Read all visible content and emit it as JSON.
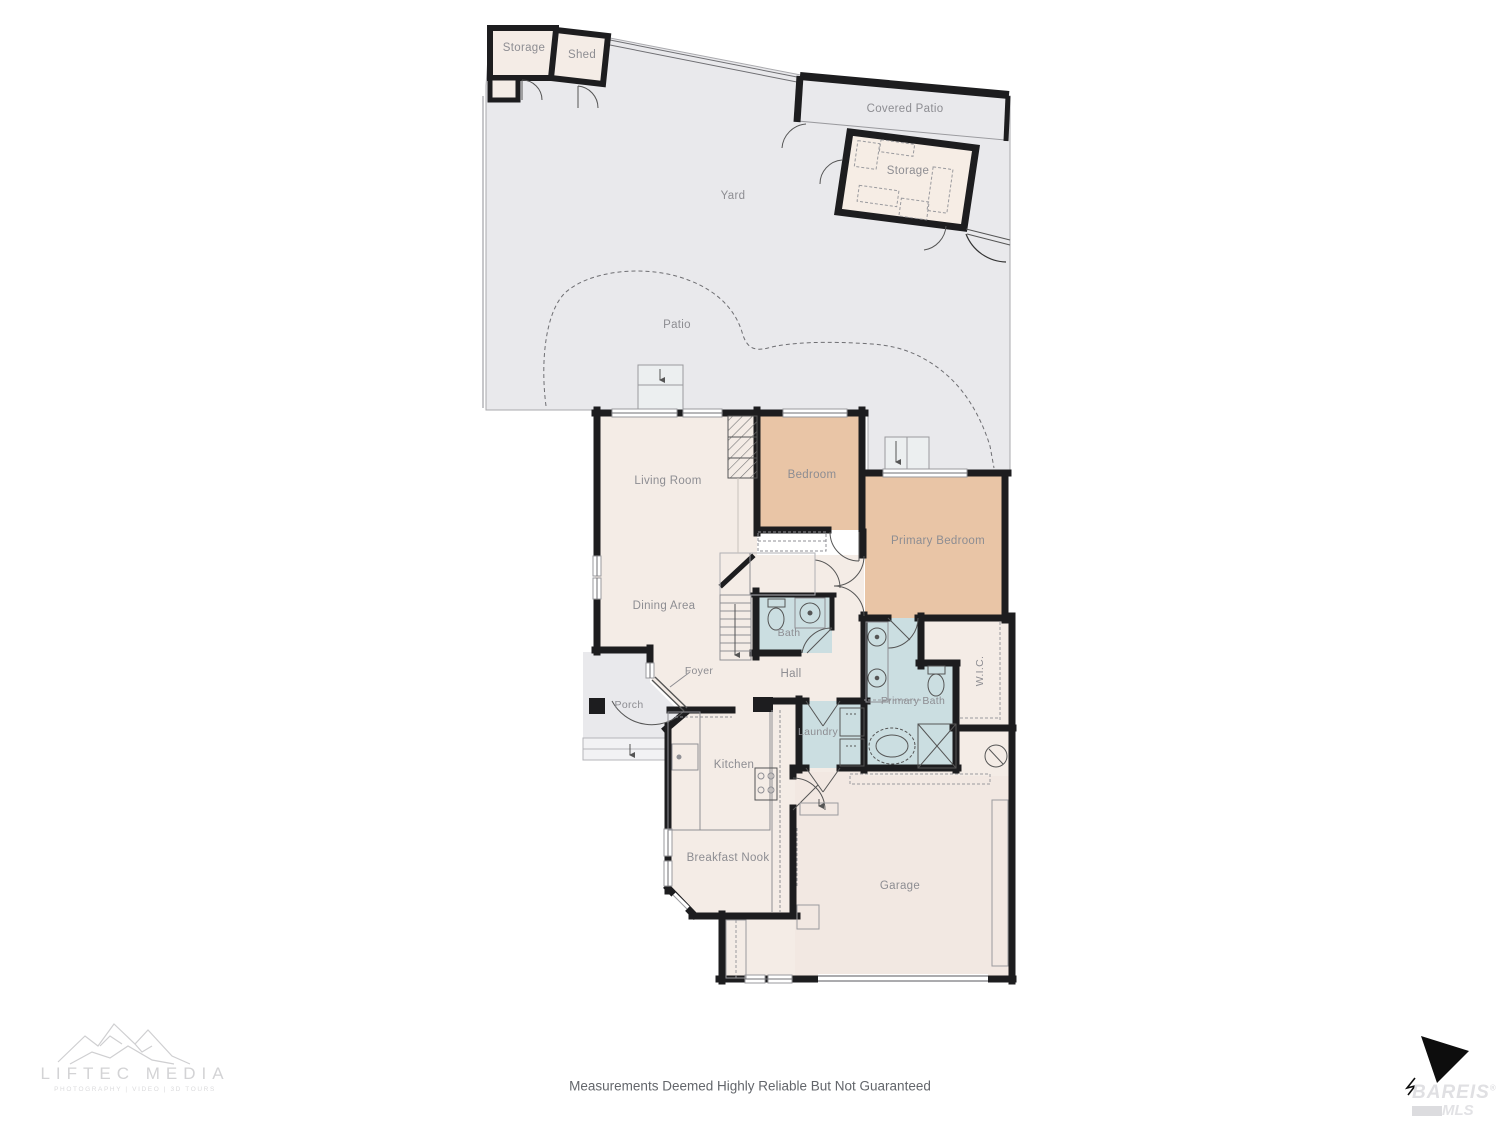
{
  "floorplan": {
    "outdoor": {
      "yard": "Yard",
      "patio": "Patio",
      "covered_patio": "Covered Patio",
      "storage_shed": "Storage",
      "shed": "Shed",
      "storage_building": "Storage",
      "porch": "Porch"
    },
    "rooms": {
      "living_room": "Living Room",
      "dining_area": "Dining Area",
      "bedroom": "Bedroom",
      "primary_bedroom": "Primary Bedroom",
      "bath": "Bath",
      "hall": "Hall",
      "foyer": "Foyer",
      "kitchen": "Kitchen",
      "laundry": "Laundry",
      "primary_bath": "Primary Bath",
      "wic": "W.I.C.",
      "breakfast_nook": "Breakfast Nook",
      "garage": "Garage"
    }
  },
  "footer": {
    "disclaimer": "Measurements Deemed Highly Reliable But Not Guaranteed"
  },
  "branding": {
    "photographer": {
      "name": "LIFTEC MEDIA",
      "tagline": "PHOTOGRAPHY | VIDEO | 3D TOURS"
    },
    "mls": {
      "name": "BAREIS",
      "reg": "®",
      "sub": "MLS"
    }
  },
  "colors": {
    "yard_gray": "#e9e9ec",
    "room_cream": "#f4ece6",
    "bedroom_tan": "#e9c5a6",
    "bath_blue": "#cbdee1",
    "wall_black": "#1d1d1f",
    "label_gray": "#8d8d92"
  }
}
